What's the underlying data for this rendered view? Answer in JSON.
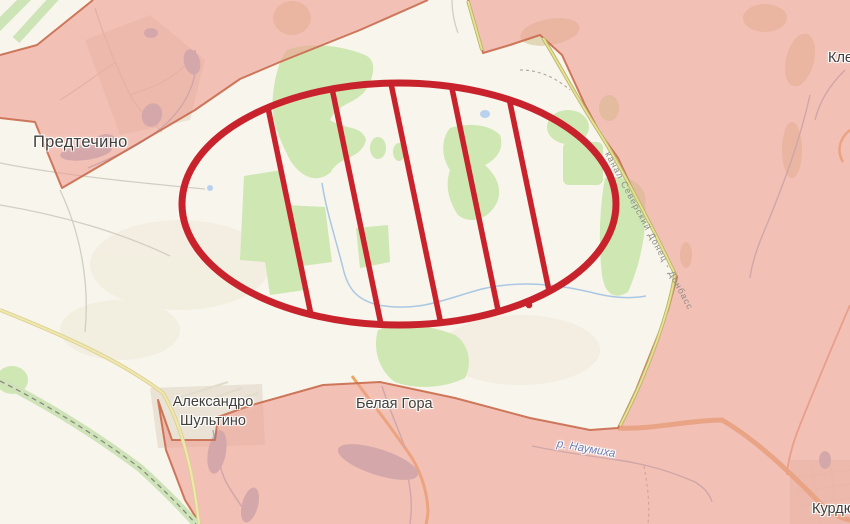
{
  "map": {
    "labels": {
      "predtechyne": "Предтечино",
      "oleksandro_shultyne": "Александро Шультино",
      "bila_hora": "Белая Гора",
      "klishchiivka_fragment": "Кле",
      "kurdiumivka_fragment": "Курдюм",
      "canal": "канал Северский Донец - Донбасс",
      "river": "р. Наумиха"
    },
    "annotation": {
      "shape": "hatched-ellipse",
      "hatch_line_count": 5,
      "has_point_marker": true
    },
    "colors": {
      "land": "#f7f5ec",
      "field_green": "#cfe7b2",
      "water": "#a9b6cf",
      "stream_blue": "#aac7e4",
      "occupied_fill": "#efa093",
      "occupied_border": "#c96b4e",
      "canal_yellow": "#e9e28c",
      "road_yellow": "#f0e7ae",
      "road_orange": "#e8a963",
      "railway_green": "#cfe3b8",
      "highlight_red": "#c8232c",
      "label_text": "#3f3e3a"
    }
  }
}
